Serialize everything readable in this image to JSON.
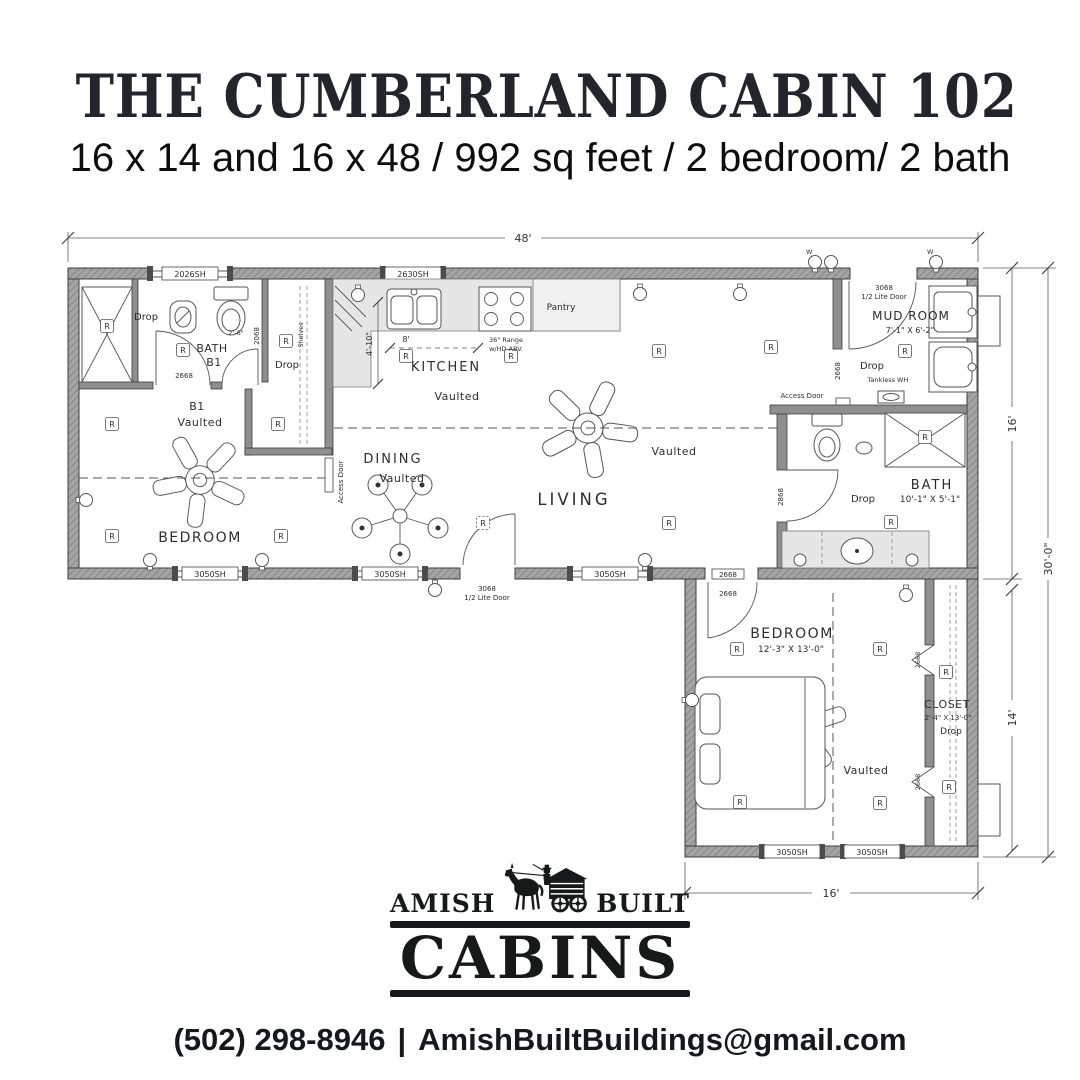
{
  "header": {
    "title": "THE CUMBERLAND CABIN 102",
    "subtitle": "16 x 14 and 16 x 48 / 992 sq feet / 2 bedroom/ 2 bath"
  },
  "floorplan": {
    "dims": {
      "main_width": "48'",
      "main_depth": "16'",
      "total_depth": "30'-0\"",
      "wing_depth": "14'",
      "wing_width": "16'"
    },
    "windows": {
      "w2026": "2026SH",
      "w2630": "2630SH",
      "w3050": "3050SH"
    },
    "doors": {
      "d2668": "2668",
      "d2068": "2068",
      "d2868": "2868",
      "d3068": "3068",
      "half_lite": "1/2 Lite Door"
    },
    "rooms": {
      "bath1_l1": "BATH",
      "bath1_l2": "B1",
      "b1": "B1",
      "bedroom1": "BEDROOM",
      "kitchen": "KITCHEN",
      "dining": "DINING",
      "living": "LIVING",
      "mudroom": "MUD ROOM",
      "mudroom_size": "7'-1\" X 6'-2\"",
      "bath2": "BATH",
      "bath2_size": "10'-1\" X 5'-1\"",
      "bedroom2": "BEDROOM",
      "bedroom2_size": "12'-3\" X 13'-0\"",
      "closet": "CLOSET",
      "closet_size": "2'-4\" X 13'-0\"",
      "vaulted": "Vaulted",
      "drop": "Drop"
    },
    "annotations": {
      "recessed": "R",
      "access_door": "Access Door",
      "shelves": "Shelves",
      "pantry": "Pantry",
      "range_l1": "36\" Range",
      "range_l2": "w/HD ABV.",
      "tankless": "Tankless WH",
      "dim_4_10": "4'-10\"",
      "dim_8": "8'",
      "dim_2_6": "2'-6\"",
      "wall_switch": "W"
    }
  },
  "logo": {
    "word_left": "AMISH",
    "word_right": "BUILT",
    "word_main": "CABINS",
    "icon": "horse-drawn-cabin-wagon"
  },
  "contact": {
    "phone": "(502) 298-8946",
    "separator": "|",
    "email": "AmishBuiltBuildings@gmail.com"
  }
}
